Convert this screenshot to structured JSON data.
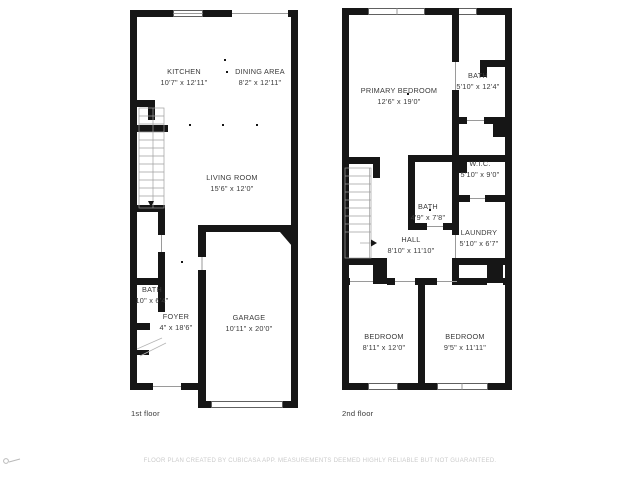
{
  "floor1": {
    "caption": "1st floor",
    "rooms": {
      "kitchen": {
        "name": "KITCHEN",
        "dims": "10'7\" x 12'11\""
      },
      "dining": {
        "name": "DINING AREA",
        "dims": "8'2\" x 12'11\""
      },
      "living": {
        "name": "LIVING ROOM",
        "dims": "15'6\" x 12'0\""
      },
      "bath": {
        "name": "BATH",
        "dims": "10\" x 6'4\""
      },
      "foyer": {
        "name": "FOYER",
        "dims": "4\" x 18'6\""
      },
      "garage": {
        "name": "GARAGE",
        "dims": "10'11\" x 20'0\""
      }
    }
  },
  "floor2": {
    "caption": "2nd floor",
    "rooms": {
      "primary_bedroom": {
        "name": "PRIMARY BEDROOM",
        "dims": "12'6\" x 19'0\""
      },
      "bath_top": {
        "name": "BATH",
        "dims": "5'10\" x 12'4\""
      },
      "wic": {
        "name": "W.I.C.",
        "dims": "5'10\" x 9'0\""
      },
      "bath_mid": {
        "name": "BATH",
        "dims": "4'9\" x 7'8\""
      },
      "hall": {
        "name": "HALL",
        "dims": "8'10\" x 11'10\""
      },
      "laundry": {
        "name": "LAUNDRY",
        "dims": "5'10\" x 6'7\""
      },
      "bedroom_left": {
        "name": "BEDROOM",
        "dims": "8'11\" x 12'0\""
      },
      "bedroom_right": {
        "name": "BEDROOM",
        "dims": "9'5\" x 11'11\""
      }
    }
  },
  "footer": {
    "disclaimer": "FLOOR PLAN CREATED BY CUBICASA APP. MEASUREMENTS DEEMED HIGHLY RELIABLE BUT NOT GUARANTEED."
  },
  "colors": {
    "wall": "#161616",
    "label_text": "#3a3a3a",
    "footer_text": "#cbcbcb"
  }
}
